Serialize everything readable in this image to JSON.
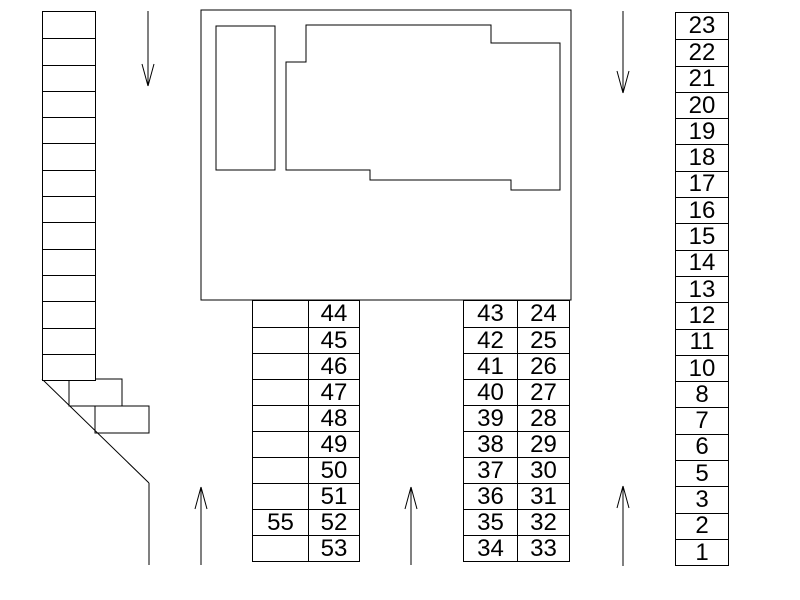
{
  "colors": {
    "background": "#ffffff",
    "line": "#000000",
    "text": "#000000"
  },
  "left_stairs": {
    "cells": [
      "",
      "",
      "",
      "",
      "",
      "",
      "",
      "",
      "",
      "",
      "",
      "",
      "",
      ""
    ]
  },
  "middle_left_table": {
    "rows": [
      {
        "left": "",
        "right": "44"
      },
      {
        "left": "",
        "right": "45"
      },
      {
        "left": "",
        "right": "46"
      },
      {
        "left": "",
        "right": "47"
      },
      {
        "left": "",
        "right": "48"
      },
      {
        "left": "",
        "right": "49"
      },
      {
        "left": "",
        "right": "50"
      },
      {
        "left": "",
        "right": "51"
      },
      {
        "left": "55",
        "right": "52"
      },
      {
        "left": "",
        "right": "53"
      }
    ]
  },
  "middle_right_table": {
    "rows": [
      {
        "left": "43",
        "right": "24"
      },
      {
        "left": "42",
        "right": "25"
      },
      {
        "left": "41",
        "right": "26"
      },
      {
        "left": "40",
        "right": "27"
      },
      {
        "left": "39",
        "right": "28"
      },
      {
        "left": "38",
        "right": "29"
      },
      {
        "left": "37",
        "right": "30"
      },
      {
        "left": "36",
        "right": "31"
      },
      {
        "left": "35",
        "right": "32"
      },
      {
        "left": "34",
        "right": "33"
      }
    ]
  },
  "right_column_table": {
    "cells": [
      "23",
      "22",
      "21",
      "20",
      "19",
      "18",
      "17",
      "16",
      "15",
      "14",
      "13",
      "12",
      "11",
      "10",
      "8",
      "7",
      "6",
      "5",
      "3",
      "2",
      "1"
    ]
  },
  "arrows": {
    "top_left_lane": "down",
    "top_right_lane": "down",
    "bottom_left_lane": "up",
    "bottom_center_lane": "up",
    "bottom_right_lane": "up"
  }
}
